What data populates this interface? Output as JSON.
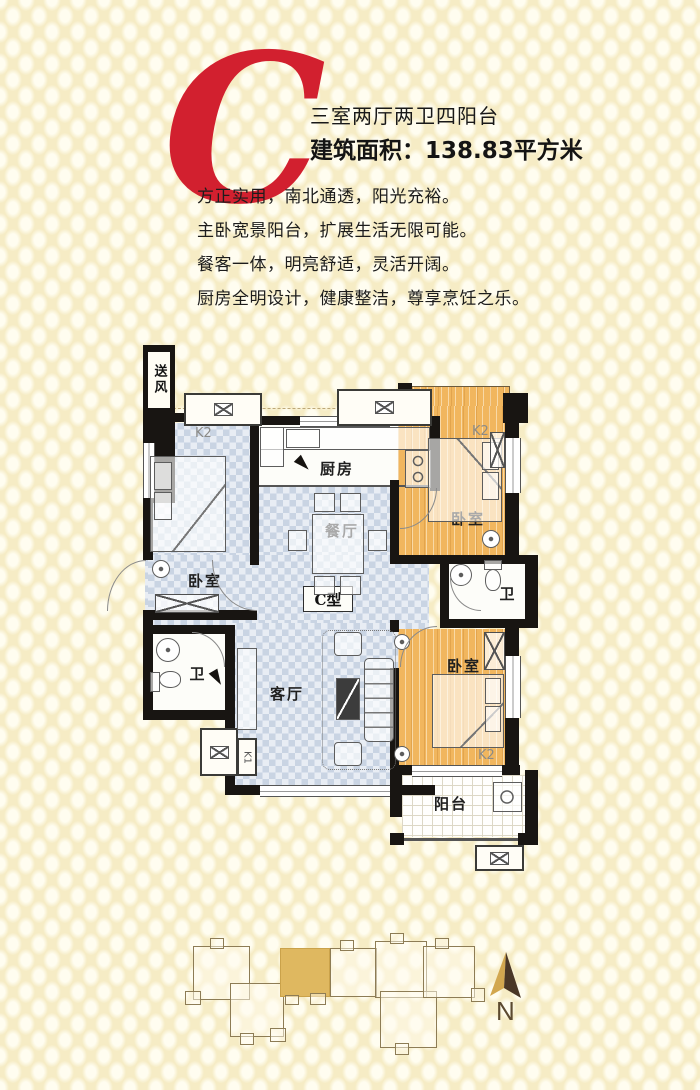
{
  "header": {
    "unit_letter": "C",
    "unit_title": "三室两厅两卫四阳台",
    "unit_area": "建筑面积：138.83平方米"
  },
  "features": [
    "方正实用，南北通透，阳光充裕。",
    "主卧宽景阳台，扩展生活无限可能。",
    "餐客一体，明亮舒适，灵活开阔。",
    "厨房全明设计，健康整洁，尊享烹饪之乐。"
  ],
  "floorplan": {
    "unit_type_label": "C型",
    "labels": {
      "bedroom": "卧室",
      "kitchen": "厨房",
      "dining": "餐厅",
      "living": "客厅",
      "bathroom": "卫",
      "balcony": "阳台",
      "air_supply": "送风",
      "k1": "K1",
      "k2": "K2"
    }
  },
  "siteplan": {
    "compass_label": "N"
  },
  "colors": {
    "accent_red": "#d2202f",
    "wall_black": "#181512",
    "wood_floor": "#f1b65e",
    "tile_blue": "#c9d4e3",
    "highlight_gold": "#dfb860",
    "background_cream": "#f6ecc5"
  }
}
